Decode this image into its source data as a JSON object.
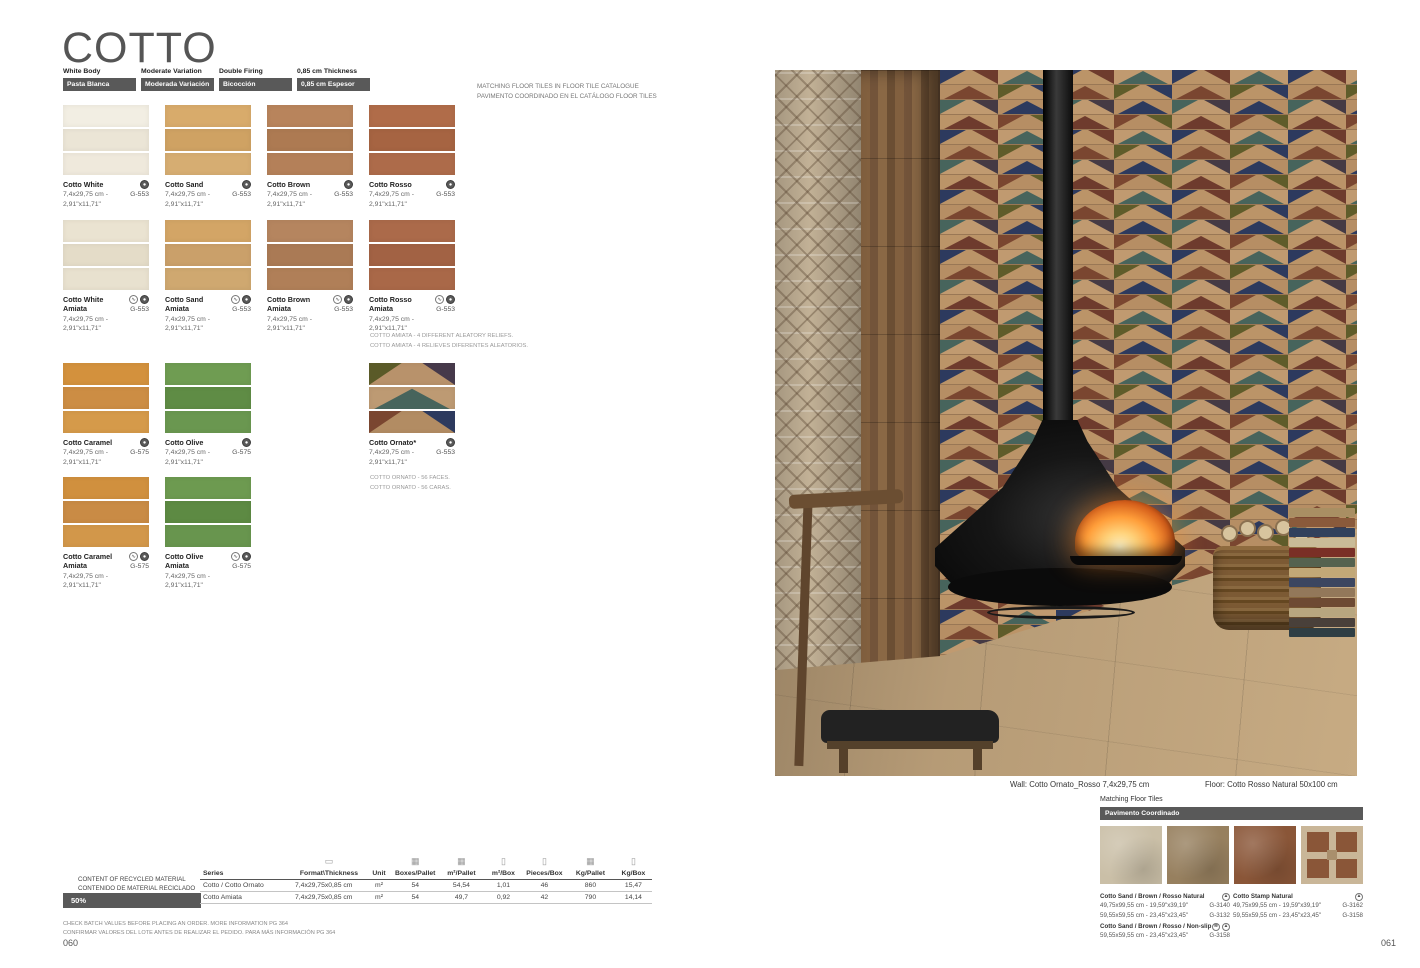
{
  "colors": {
    "badge_bg": "#595959",
    "badge_text": "#ffffff",
    "title_text": "#555555"
  },
  "icon_glyphs": {
    "structure": "∿",
    "gloss": "●",
    "natural": "▲",
    "nonslip": "≋",
    "pallet": "▭",
    "boxes": "▦",
    "box": "▯"
  },
  "page_left": {
    "title": "COTTO",
    "spec_badges": [
      {
        "en": "White Body",
        "es": "Pasta Blanca"
      },
      {
        "en": "Moderate Variation",
        "es": "Moderada Variación"
      },
      {
        "en": "Double Firing",
        "es": "Bicocción"
      },
      {
        "en": "0,85 cm Thickness",
        "es": "0,85 cm Espesor"
      }
    ],
    "matching_note": [
      "MATCHING FLOOR TILES IN FLOOR TILE CATALOGUE",
      "PAVIMENTO COORDINADO EN EL CATÁLOGO FLOOR TILES"
    ],
    "products": [
      {
        "row": 1,
        "col": 1,
        "name": "Cotto White",
        "size1": "7,4x29,75 cm -",
        "size2": "2,91\"x11,71\"",
        "code": "G-553",
        "icons": [
          "gloss"
        ],
        "strips": [
          "#f2eee3",
          "#ebe5d6",
          "#efe9dc"
        ]
      },
      {
        "row": 1,
        "col": 2,
        "name": "Cotto Sand",
        "size1": "7,4x29,75 cm -",
        "size2": "2,91\"x11,71\"",
        "code": "G-553",
        "icons": [
          "gloss"
        ],
        "strips": [
          "#d8ab6b",
          "#cfa263",
          "#d6ad72"
        ]
      },
      {
        "row": 1,
        "col": 3,
        "name": "Cotto Brown",
        "size1": "7,4x29,75 cm -",
        "size2": "2,91\"x11,71\"",
        "code": "G-553",
        "icons": [
          "gloss"
        ],
        "strips": [
          "#b8845c",
          "#ad7a52",
          "#b48059"
        ]
      },
      {
        "row": 1,
        "col": 4,
        "name": "Cotto Rosso",
        "size1": "7,4x29,75 cm -",
        "size2": "2,91\"x11,71\"",
        "code": "G-553",
        "icons": [
          "gloss"
        ],
        "strips": [
          "#b06c49",
          "#a66442",
          "#ad6b4a"
        ]
      },
      {
        "row": 2,
        "col": 1,
        "name": "Cotto White Amiata",
        "size1": "7,4x29,75 cm -",
        "size2": "2,91\"x11,71\"",
        "code": "G-553",
        "icons": [
          "structure",
          "gloss"
        ],
        "amiata": true,
        "strips": [
          "#eae3d1",
          "#e4dcc8",
          "#e8e1cf"
        ]
      },
      {
        "row": 2,
        "col": 2,
        "name": "Cotto Sand Amiata",
        "size1": "7,4x29,75 cm -",
        "size2": "2,91\"x11,71\"",
        "code": "G-553",
        "icons": [
          "structure",
          "gloss"
        ],
        "amiata": true,
        "strips": [
          "#d3a566",
          "#caa06a",
          "#cfa870"
        ]
      },
      {
        "row": 2,
        "col": 3,
        "name": "Cotto Brown Amiata",
        "size1": "7,4x29,75 cm -",
        "size2": "2,91\"x11,71\"",
        "code": "G-553",
        "icons": [
          "structure",
          "gloss"
        ],
        "amiata": true,
        "strips": [
          "#b5855f",
          "#aa7a55",
          "#b07f58"
        ]
      },
      {
        "row": 2,
        "col": 4,
        "name": "Cotto Rosso Amiata",
        "size1": "7,4x29,75 cm -",
        "size2": "2,91\"x11,71\"",
        "code": "G-553",
        "icons": [
          "structure",
          "gloss"
        ],
        "amiata": true,
        "strips": [
          "#ab6a4a",
          "#a26244",
          "#a96848"
        ]
      },
      {
        "row": 3,
        "col": 1,
        "name": "Cotto Caramel",
        "size1": "7,4x29,75 cm -",
        "size2": "2,91\"x11,71\"",
        "code": "G-575",
        "icons": [
          "gloss"
        ],
        "strips": [
          "#d3913d",
          "#cc8d44",
          "#d59a4a"
        ]
      },
      {
        "row": 3,
        "col": 2,
        "name": "Cotto Olive",
        "size1": "7,4x29,75 cm -",
        "size2": "2,91\"x11,71\"",
        "code": "G-575",
        "icons": [
          "gloss"
        ],
        "strips": [
          "#6f9c52",
          "#5f8c45",
          "#6a9750"
        ]
      },
      {
        "row": 3,
        "col": 4,
        "name": "Cotto Ornato*",
        "size1": "7,4x29,75 cm -",
        "size2": "2,91\"x11,71\"",
        "code": "G-553",
        "icons": [
          "gloss"
        ],
        "ornato": [
          {
            "bg": "#b8926b",
            "tris": [
              {
                "pos": "l",
                "c": "#5a5a28"
              },
              {
                "pos": "r",
                "c": "#46394a"
              }
            ]
          },
          {
            "bg": "#bd9a73",
            "tris": [
              {
                "pos": "c",
                "c": "#47645c"
              }
            ]
          },
          {
            "bg": "#b28c63",
            "tris": [
              {
                "pos": "l",
                "c": "#7a4630"
              },
              {
                "pos": "r",
                "c": "#2d3a5e"
              }
            ]
          }
        ]
      },
      {
        "row": 4,
        "col": 1,
        "name": "Cotto Caramel Amiata",
        "size1": "7,4x29,75 cm -",
        "size2": "2,91\"x11,71\"",
        "code": "G-575",
        "icons": [
          "structure",
          "gloss"
        ],
        "amiata": true,
        "strips": [
          "#d0903e",
          "#c98b45",
          "#d2974a"
        ]
      },
      {
        "row": 4,
        "col": 2,
        "name": "Cotto Olive Amiata",
        "size1": "7,4x29,75 cm -",
        "size2": "2,91\"x11,71\"",
        "code": "G-575",
        "icons": [
          "structure",
          "gloss"
        ],
        "amiata": true,
        "strips": [
          "#6d9a50",
          "#5d8a43",
          "#68954e"
        ]
      }
    ],
    "notes": {
      "amiata": [
        "COTTO AMIATA - 4 DIFFERENT ALEATORY RELIEFS.",
        "COTTO AMIATA - 4 RELIEVES DIFERENTES ALEATORIOS."
      ],
      "ornato": [
        "COTTO ORNATO - 56 FACES.",
        "COTTO ORNATO - 56 CARAS."
      ]
    },
    "recycled": {
      "line1": "CONTENT OF RECYCLED MATERIAL",
      "line2": "CONTENIDO DE MATERIAL RECICLADO",
      "value": "50%"
    },
    "table": {
      "headers": [
        {
          "label": "Series"
        },
        {
          "label": "Format\\Thickness",
          "icon": "pallet"
        },
        {
          "label": "Unit"
        },
        {
          "label": "Boxes/Pallet",
          "icon": "boxes"
        },
        {
          "label": "m²/Pallet",
          "icon": "boxes"
        },
        {
          "label": "m²/Box",
          "icon": "box"
        },
        {
          "label": "Pieces/Box",
          "icon": "box"
        },
        {
          "label": "Kg/Pallet",
          "icon": "boxes"
        },
        {
          "label": "Kg/Box",
          "icon": "box"
        }
      ],
      "rows": [
        [
          "Cotto / Cotto Ornato",
          "7,4x29,75x0,85 cm",
          "m²",
          "54",
          "54,54",
          "1,01",
          "46",
          "860",
          "15,47"
        ],
        [
          "Cotto Amiata",
          "7,4x29,75x0,85 cm",
          "m²",
          "54",
          "49,7",
          "0,92",
          "42",
          "790",
          "14,14"
        ]
      ]
    },
    "footnotes": [
      "CHECK BATCH VALUES BEFORE PLACING AN ORDER. MORE INFORMATION PG 364",
      "CONFIRMAR VALORES DEL LOTE ANTES DE REALIZAR EL PEDIDO. PARA MÁS INFORMACIÓN PG 364"
    ],
    "page_number": "060"
  },
  "page_right": {
    "captions": {
      "wall": "Wall: Cotto Ornato_Rosso 7,4x29,75 cm",
      "floor": "Floor: Cotto Rosso Natural 50x100 cm"
    },
    "matching": {
      "title": "Matching Floor Tiles",
      "badge": "Pavimento Coordinado",
      "swatches": [
        {
          "type": "plain",
          "color": "#cabfa7"
        },
        {
          "type": "plain",
          "color": "#97805f"
        },
        {
          "type": "plain",
          "color": "#8a5638"
        },
        {
          "type": "stamp",
          "bg": "#c9b698",
          "square": "#8a5638",
          "center": "#a98f6d"
        }
      ],
      "items": [
        {
          "col": 1,
          "name": "Cotto Sand / Brown / Rosso Natural",
          "icons": [
            "natural"
          ],
          "lines": [
            {
              "size": "49,75x99,55 cm - 19,59\"x39,19\"",
              "code": "G-3140"
            },
            {
              "size": "59,55x59,55 cm - 23,45\"x23,45\"",
              "code": "G-3132"
            }
          ]
        },
        {
          "col": 1,
          "name": "Cotto Sand / Brown / Rosso / Non-slip",
          "icons": [
            "nonslip",
            "natural"
          ],
          "lines": [
            {
              "size": "59,55x59,55 cm - 23,45\"x23,45\"",
              "code": "G-3158"
            }
          ]
        },
        {
          "col": 2,
          "name": "Cotto Stamp Natural",
          "icons": [
            "natural"
          ],
          "lines": [
            {
              "size": "49,75x99,55 cm - 19,59\"x39,19\"",
              "code": "G-3162"
            },
            {
              "size": "59,55x59,55 cm - 23,45\"x23,45\"",
              "code": "G-3158"
            }
          ]
        }
      ]
    },
    "page_number": "061"
  }
}
